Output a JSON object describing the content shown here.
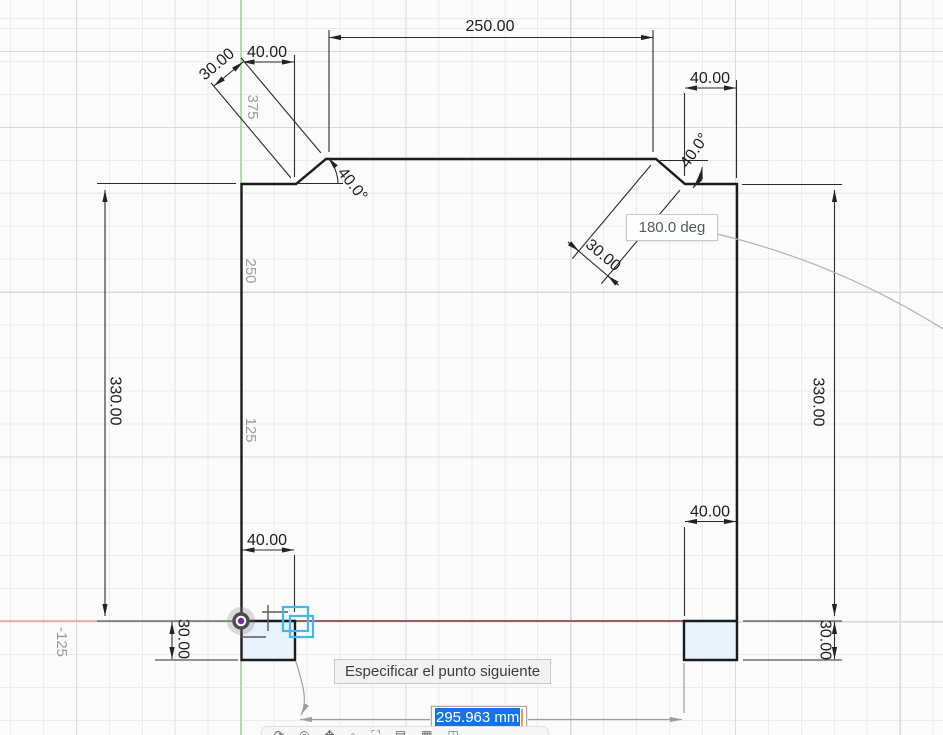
{
  "tooltip": "Especificar el punto siguiente",
  "inputs": {
    "length": {
      "value": "295.963 mm",
      "selected": true
    },
    "angle": {
      "value": "180.0 deg"
    }
  },
  "dimensions": {
    "top_width": "250.00",
    "top_left_offset": "40.00",
    "top_left_chamfer": "30.00",
    "top_left_angle": "40.0°",
    "top_right_width": "40.00",
    "top_right_chamfer": "30.00",
    "top_right_angle": "40.0°",
    "left_height": "330.00",
    "right_height": "330.00",
    "bottom_left_tab_width": "40.00",
    "bottom_left_tab_height": "30.00",
    "bottom_right_tab_width": "40.00",
    "bottom_right_tab_height": "30.00"
  },
  "grid_labels": {
    "y_375": "375",
    "y_250": "250",
    "y_125": "125",
    "x_neg_125": "-125"
  },
  "colors": {
    "x_axis_light": "#ef9b9b",
    "x_axis_dark": "#8d4b4b",
    "y_axis": "#a3d6a3",
    "selection_blue": "#1473e6",
    "caret_orange": "#ff9933",
    "snap_cyan": "#41b9ef",
    "profile_fill": "#e8f2fa",
    "origin_purple": "#7b2c95"
  },
  "toolbar": {
    "icons": [
      {
        "name": "orbit",
        "glyph": "⟳"
      },
      {
        "name": "look-at",
        "glyph": "◎"
      },
      {
        "name": "pan",
        "glyph": "✥"
      },
      {
        "name": "zoom",
        "glyph": "⌕"
      },
      {
        "name": "fit",
        "glyph": "⛶"
      },
      {
        "name": "display-settings",
        "glyph": "▤"
      },
      {
        "name": "grid-and-snaps",
        "glyph": "▦"
      },
      {
        "name": "viewports",
        "glyph": "◫"
      }
    ]
  }
}
